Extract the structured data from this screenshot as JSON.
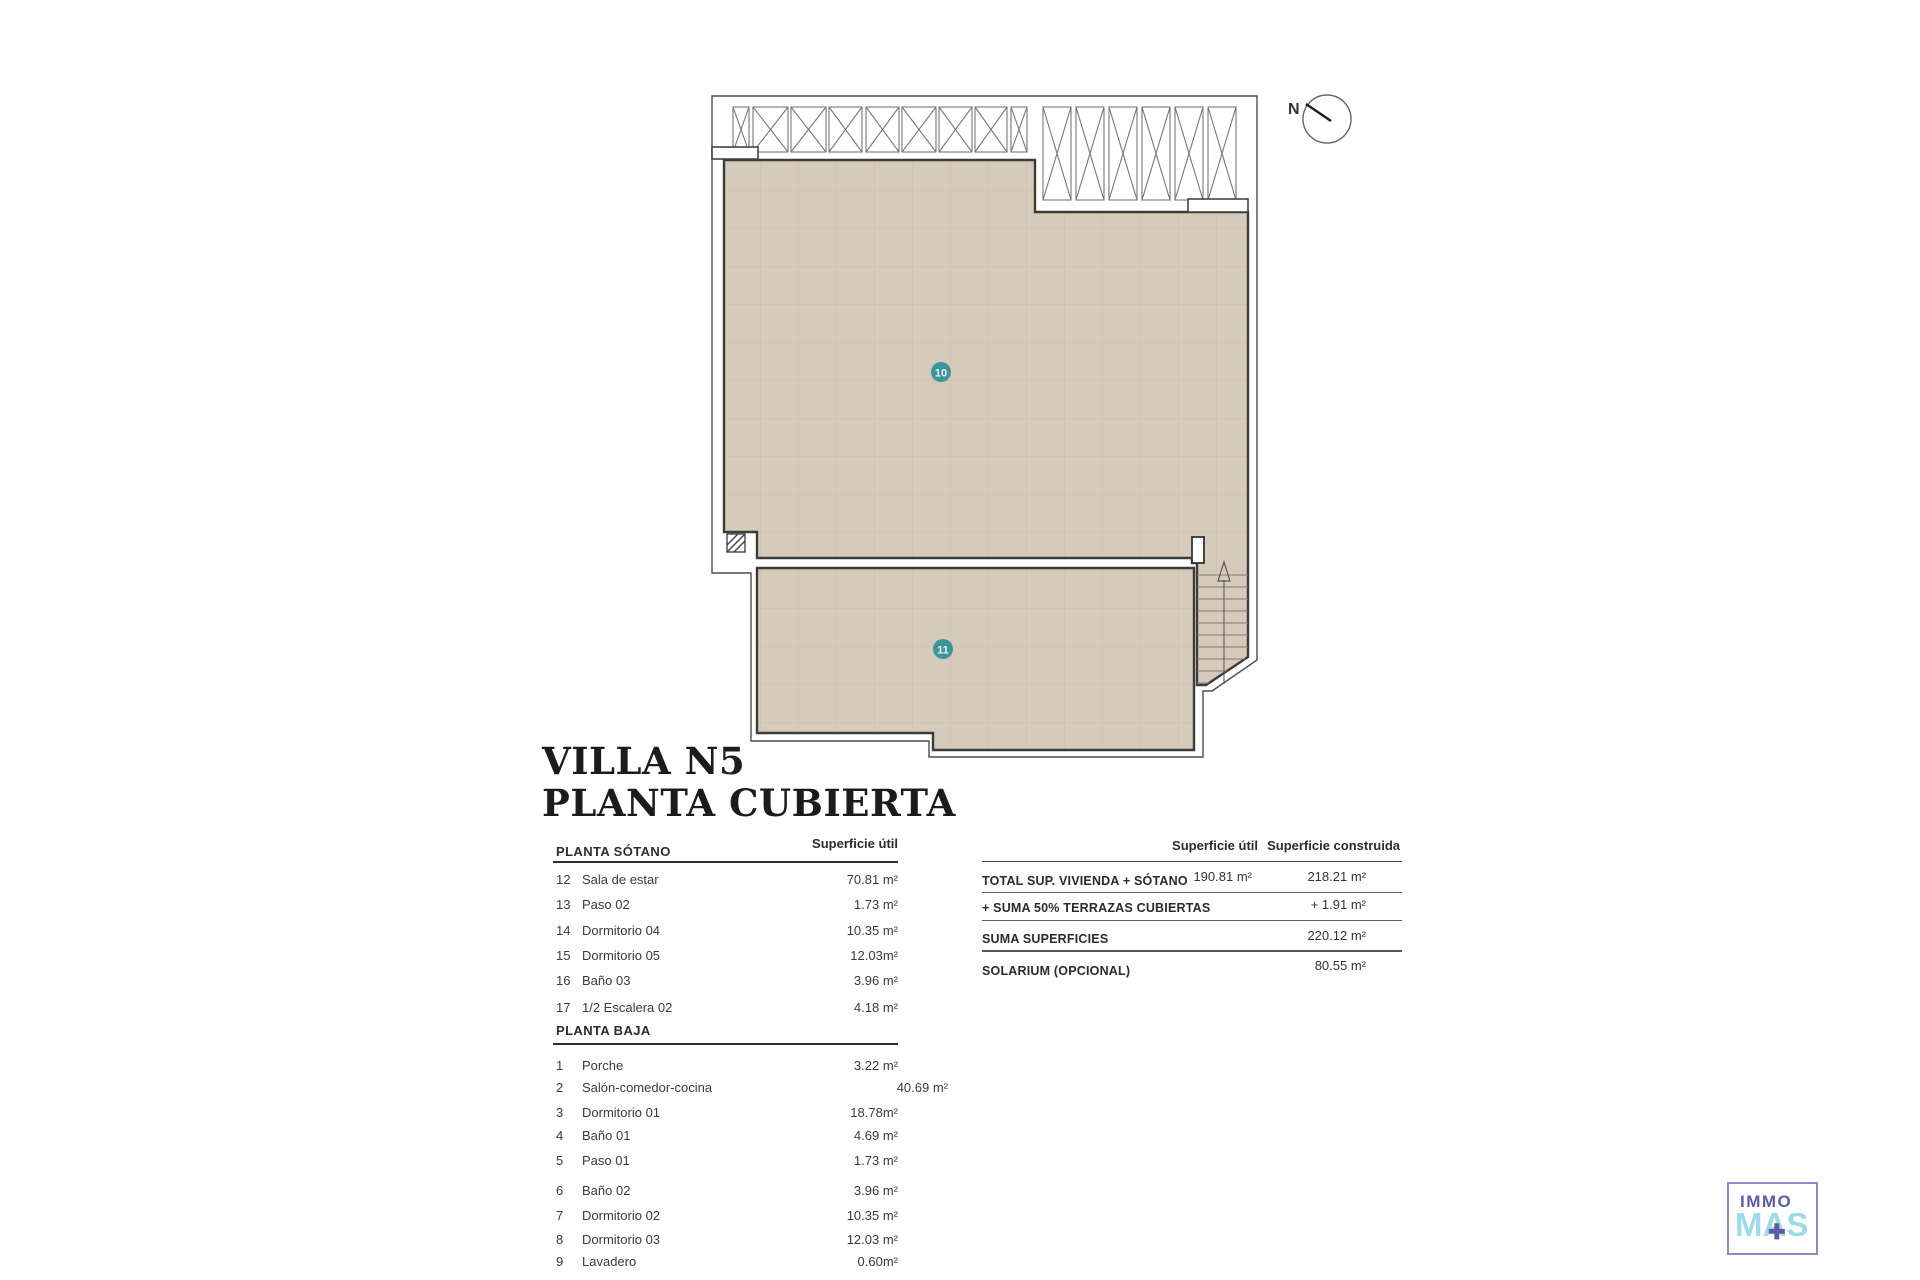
{
  "colors": {
    "roof_fill": "#d6cabb",
    "roof_grid": "#c3b4a0",
    "accent_teal": "#3e949b",
    "outline_dark": "#3b3b3b",
    "logo_purple": "#5d5ca3",
    "logo_blue": "#9edbe9"
  },
  "plan": {
    "north_label": "N",
    "roof_label_10": "10",
    "roof_label_11": "11"
  },
  "title": {
    "line1": "VILLA N5",
    "line2": "PLANTA CUBIERTA"
  },
  "sotano": {
    "title": "PLANTA SÓTANO",
    "col": "Superficie útil",
    "rows": [
      {
        "n": "12",
        "name": "Sala de estar",
        "v": "70.81 m²"
      },
      {
        "n": "13",
        "name": "Paso 02",
        "v": "1.73 m²"
      },
      {
        "n": "14",
        "name": "Dormitorio 04",
        "v": "10.35 m²"
      },
      {
        "n": "15",
        "name": "Dormitorio 05",
        "v": "12.03m²"
      },
      {
        "n": "16",
        "name": "Baño 03",
        "v": "3.96 m²"
      },
      {
        "n": "17",
        "name": "1/2 Escalera 02",
        "v": "4.18 m²"
      }
    ]
  },
  "baja": {
    "title": "PLANTA BAJA",
    "rows": [
      {
        "n": "1",
        "name": "Porche",
        "v": "3.22 m²"
      },
      {
        "n": "2",
        "name": "Salón-comedor-cocina",
        "v": "40.69 m²"
      },
      {
        "n": "3",
        "name": "Dormitorio 01",
        "v": "18.78m²"
      },
      {
        "n": "4",
        "name": "Baño 01",
        "v": "4.69 m²"
      },
      {
        "n": "5",
        "name": "Paso 01",
        "v": "1.73 m²"
      },
      {
        "n": "6",
        "name": "Baño 02",
        "v": "3.96 m²"
      },
      {
        "n": "7",
        "name": "Dormitorio 02",
        "v": "10.35 m²"
      },
      {
        "n": "8",
        "name": "Dormitorio 03",
        "v": "12.03 m²"
      },
      {
        "n": "9",
        "name": "Lavadero",
        "v": "0.60m²"
      }
    ]
  },
  "summary": {
    "col_util": "Superficie útil",
    "col_cons": "Superficie construida",
    "rows": [
      {
        "label": "TOTAL SUP. VIVIENDA + SÓTANO",
        "util": "190.81  m²",
        "cons": "218.21 m²"
      },
      {
        "label": "+ SUMA 50% TERRAZAS CUBIERTAS",
        "util": "",
        "cons": "+ 1.91 m²"
      },
      {
        "label": "SUMA SUPERFICIES",
        "util": "",
        "cons": "220.12 m²"
      },
      {
        "label": "SOLARIUM (OPCIONAL)",
        "util": "",
        "cons": "80.55 m²"
      }
    ]
  },
  "logo": {
    "line1": "IMMO",
    "line2": "MAS",
    "plus": "+"
  }
}
